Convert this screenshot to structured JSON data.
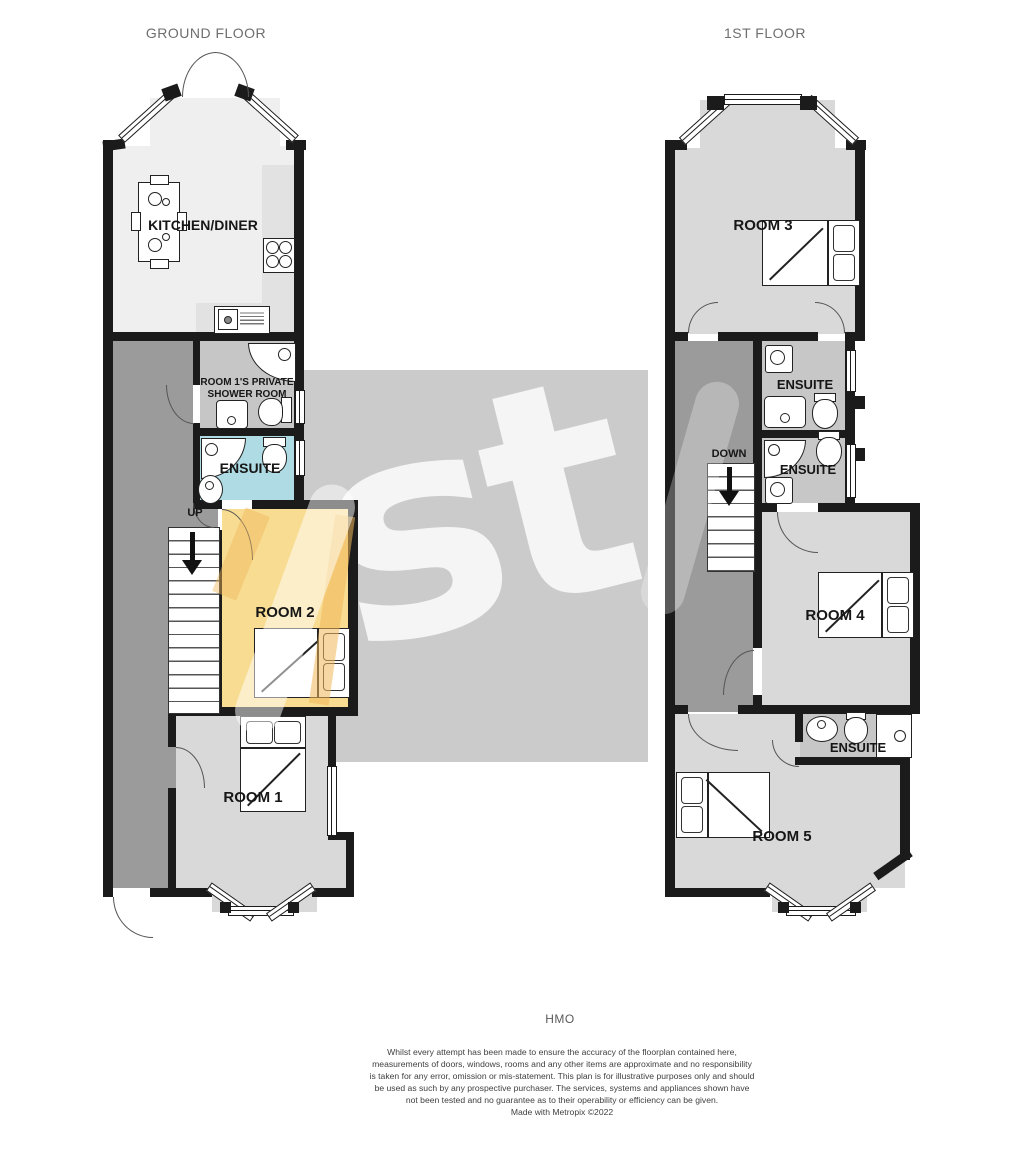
{
  "titles": {
    "ground_floor": "GROUND FLOOR",
    "first_floor": "1ST FLOOR"
  },
  "ground_floor": {
    "kitchen": "KITCHEN/DINER",
    "shower_room": "ROOM 1'S PRIVATE SHOWER ROOM",
    "ensuite": "ENSUITE",
    "stairs": "UP",
    "room2": "ROOM 2",
    "room1": "ROOM 1"
  },
  "first_floor": {
    "room3": "ROOM 3",
    "ensuite_top": "ENSUITE",
    "ensuite_mid": "ENSUITE",
    "ensuite_bottom": "ENSUITE",
    "stairs": "DOWN",
    "room4": "ROOM 4",
    "room5": "ROOM 5"
  },
  "watermark": "st",
  "footer": {
    "category": "HMO",
    "disclaimer": "Whilst every attempt has been made to ensure the accuracy of the floorplan contained here, measurements of doors, windows, rooms and any other items are approximate and no responsibility is taken for any error, omission or mis-statement. This plan is for illustrative purposes only and should be used as such by any prospective purchaser. The services, systems and appliances shown have not been tested and no guarantee as to their operability or efficiency can be given.",
    "credit": "Made with Metropix ©2022"
  },
  "colors": {
    "wall": "#1b1b1b",
    "kitchen_floor": "#efefef",
    "hall_floor": "#9b9b9b",
    "shower_floor": "#c6c6c6",
    "ensuite_blue": "#aedbe4",
    "room2_yellow": "#f8dc92",
    "room2_accent": "#f0b85a",
    "room_gray": "#d9d9d9",
    "ensuite_gray": "#c7c7c7",
    "watermark_box": "#cbcbcb"
  }
}
